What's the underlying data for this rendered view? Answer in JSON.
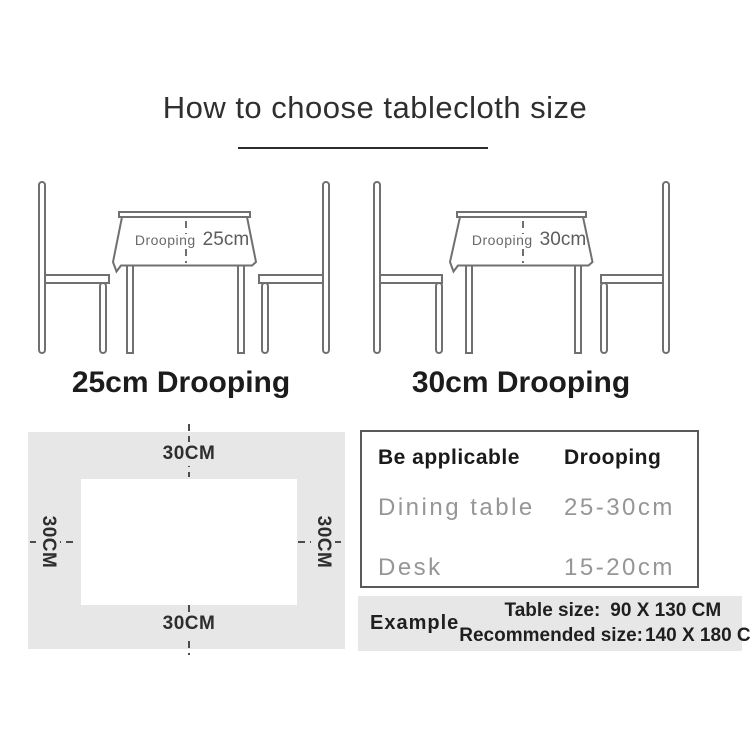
{
  "title": "How to choose tablecloth size",
  "illustrations": [
    {
      "droop_label": "Drooping",
      "droop_value": "25cm",
      "caption": "25cm Drooping"
    },
    {
      "droop_label": "Drooping",
      "droop_value": "30cm",
      "caption": "30cm Drooping"
    }
  ],
  "size_diagram": {
    "top_label": "30CM",
    "bottom_label": "30CM",
    "left_label": "30CM",
    "right_label": "30CM"
  },
  "spec_table": {
    "headers": [
      "Be applicable",
      "Drooping"
    ],
    "rows": [
      [
        "Dining table",
        "25-30cm"
      ],
      [
        "Desk",
        "15-20cm"
      ]
    ]
  },
  "example": {
    "label": "Example",
    "table_size_label": "Table size:",
    "table_size_value": "90 X 130 CM",
    "recommended_label": "Recommended size:",
    "recommended_value": "140 X 180 CM"
  },
  "colors": {
    "line_gray": "#707070",
    "panel_gray": "#e7e7e7",
    "text_dark": "#1f1f1f",
    "text_gray": "#969696"
  }
}
